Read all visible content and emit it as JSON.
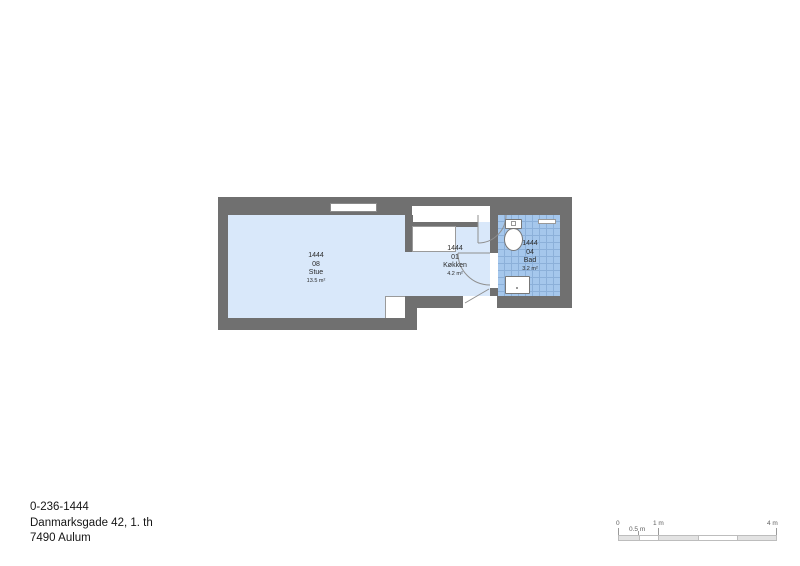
{
  "colors": {
    "wall": "#707070",
    "room_fill": "#d9e8fa",
    "bath_fill": "#a5c7ec",
    "bath_grid": "#8cb0d9",
    "line": "#8f8f8f",
    "text": "#2b2b2b"
  },
  "rooms": {
    "stue": {
      "number": "1444",
      "unit": "08",
      "name": "Stue",
      "area": "13.5 m²"
    },
    "kokken": {
      "number": "1444",
      "unit": "01",
      "name": "Køkken",
      "area": "4.2 m²"
    },
    "bad": {
      "number": "1444",
      "unit": "04",
      "name": "Bad",
      "area": "3.2 m²"
    }
  },
  "address": {
    "id": "0-236-1444",
    "street": "Danmarksgade 42, 1. th",
    "city": "7490 Aulum"
  },
  "scale_bar": {
    "labels": {
      "zero": "0",
      "half": "0.5 m",
      "one": "1 m",
      "four": "4 m"
    }
  }
}
